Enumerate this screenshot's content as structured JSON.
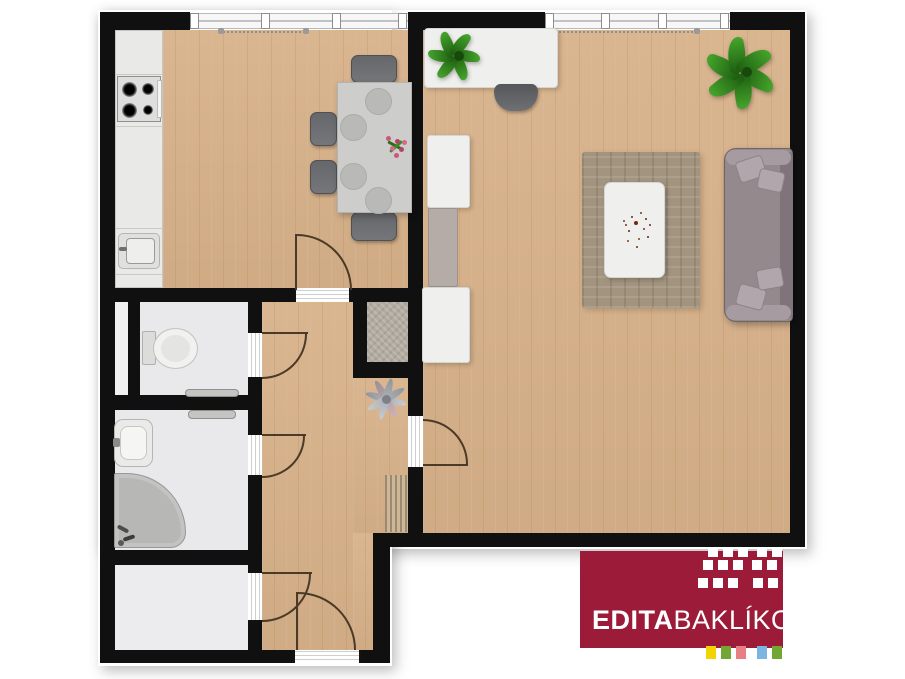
{
  "logo": {
    "brand_first_name": "EDITA",
    "brand_last_name": "BAKLÍKOVÁ",
    "background_color": "#9c1b38",
    "text_color": "#ffffff",
    "pattern_color": "#ffffff",
    "accent_colors": [
      "#f3d403",
      "#72a733",
      "#e87f84",
      "#7cb5e2",
      "#72a733"
    ]
  },
  "plan": {
    "colors": {
      "walls": "#101010",
      "wood_floor": "#d8b28a",
      "tile_floor": "#e9e9eb",
      "rug": "#a3947f",
      "sofa": "#948a8e",
      "counter": "#e9e9e7",
      "plant": "#3a8f20",
      "door_swing": "#4a3a26"
    },
    "rooms": [
      "kitchen-dining-room",
      "living-room",
      "hallway",
      "wc",
      "bathroom",
      "storage-room",
      "closet-niche",
      "installation-shaft"
    ],
    "furniture": [
      "kitchen-counter",
      "stove",
      "kitchen-sink",
      "dining-table",
      "dining-chairs",
      "desk",
      "desk-plant",
      "office-chair",
      "wall-cabinets",
      "area-rug",
      "coffee-table",
      "sofa",
      "floor-plant",
      "ceiling-fan",
      "doormat",
      "toilet",
      "wc-radiator",
      "bathroom-shelf",
      "washbasin",
      "corner-bathtub"
    ],
    "openings": [
      "kitchen-window",
      "living-room-window",
      "dining-to-hall-door",
      "wc-door",
      "bathroom-door",
      "storage-room-door",
      "living-room-door",
      "entrance-door"
    ]
  }
}
